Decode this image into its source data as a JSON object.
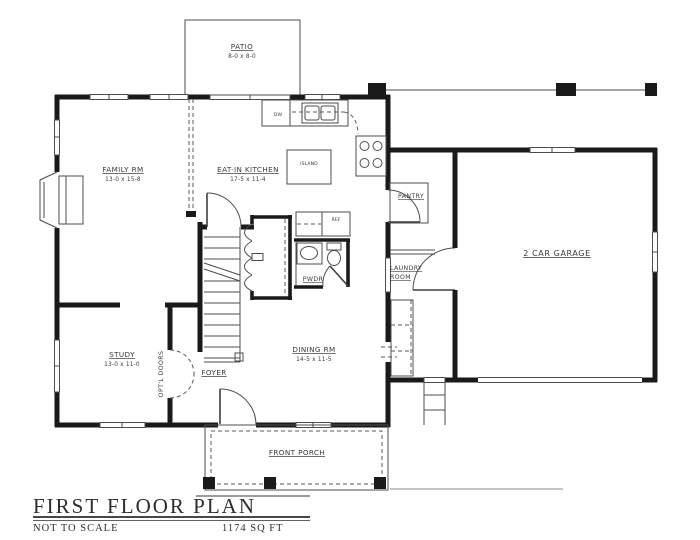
{
  "palette": {
    "wall": "#1a1a1a",
    "thin_line": "#4d4d4d",
    "text": "#3a3a3a",
    "background": "#ffffff"
  },
  "rooms": {
    "patio": {
      "name": "PATIO",
      "dims": "8-0 x 8-0"
    },
    "family": {
      "name": "FAMILY RM",
      "dims": "13-0 x 15-8"
    },
    "kitchen": {
      "name": "EAT-IN KITCHEN",
      "dims": "17-5 x 11-4"
    },
    "pantry": {
      "name": "PANTRY"
    },
    "laundry": {
      "line1": "LAUNDRY",
      "line2": "ROOM"
    },
    "powder": {
      "name": "PWDR"
    },
    "garage": {
      "name": "2 CAR GARAGE"
    },
    "study": {
      "name": "STUDY",
      "dims": "13-0 x 11-0"
    },
    "foyer": {
      "name": "FOYER"
    },
    "dining": {
      "name": "DINING RM",
      "dims": "14-5 x 11-5"
    },
    "porch": {
      "name": "FRONT PORCH"
    }
  },
  "fixtures": {
    "island": "ISLAND",
    "dishwasher": "DW",
    "refrigerator": "REF"
  },
  "annotations": {
    "optional_doors": "OPT'L DOORS"
  },
  "title_block": {
    "title": "FIRST FLOOR PLAN",
    "scale_note": "NOT TO SCALE",
    "area": "1174 SQ FT"
  }
}
